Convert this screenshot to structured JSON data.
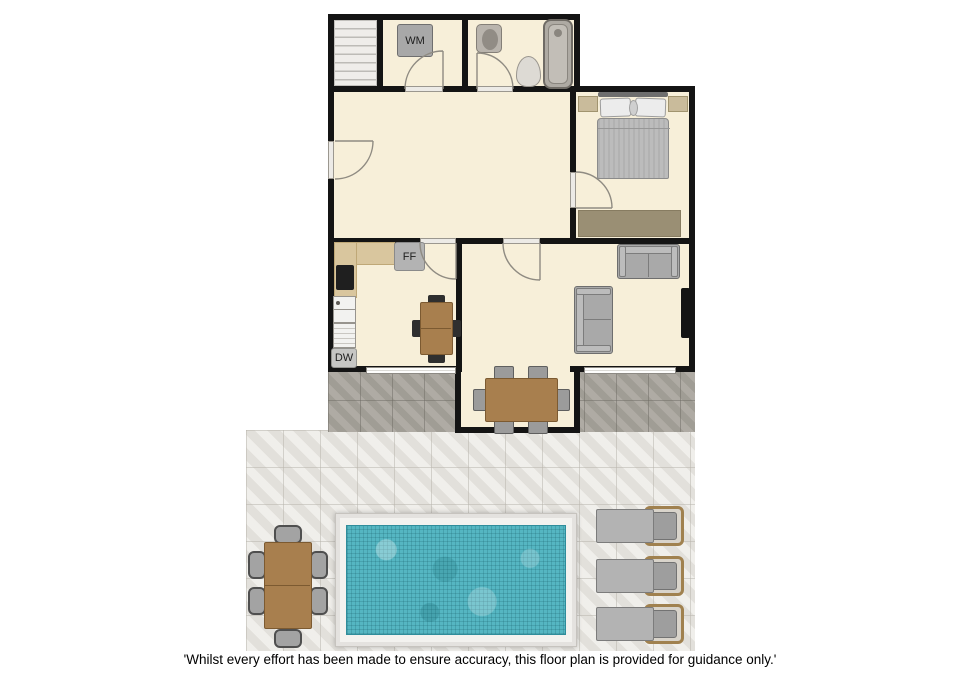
{
  "labels": {
    "washing_machine": "WM",
    "fridge_freezer": "FF",
    "dishwasher": "DW"
  },
  "caption": "'Whilst every effort has been made to ensure accuracy, this floor plan is provided for guidance only.'",
  "colors": {
    "wall": "#141414",
    "floor": "#f7efd9",
    "counter": "#d9c69e",
    "wood": "#a87f4e",
    "sofa": "#a9a9a9",
    "rug": "#9a8f74",
    "patio_dark": "#a9a59d",
    "patio_light": "#e8e6e1",
    "pool_water": "#55b6c2",
    "pool_deck": "#f3f2ef"
  }
}
